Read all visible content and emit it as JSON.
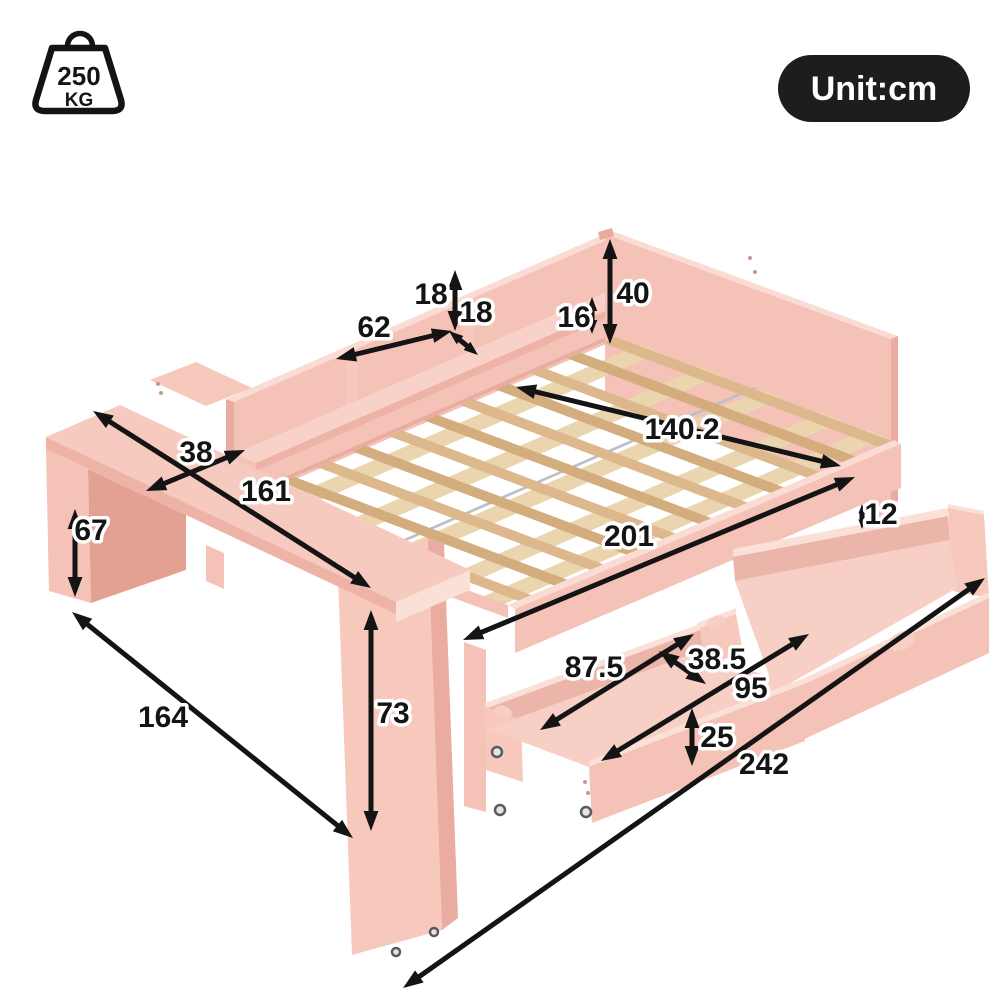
{
  "unit_badge": {
    "label": "Unit:cm"
  },
  "weight_capacity": {
    "value": "250",
    "unit": "KG"
  },
  "unit": "cm",
  "dimensions": [
    {
      "id": "shelf-height",
      "value": "18",
      "label": [
        431,
        293
      ],
      "arrow": [
        455,
        270,
        455,
        331
      ]
    },
    {
      "id": "shelf-depth",
      "value": "18",
      "label": [
        476,
        311
      ],
      "arrow": [
        449,
        331,
        478,
        355
      ]
    },
    {
      "id": "shelf-width",
      "value": "62",
      "label": [
        374,
        326
      ],
      "arrow": [
        336,
        359,
        452,
        331
      ]
    },
    {
      "id": "side-rail-height",
      "value": "16",
      "label": [
        574,
        316
      ],
      "arrow": [
        592,
        297,
        592,
        334
      ]
    },
    {
      "id": "headboard-height",
      "value": "40",
      "label": [
        633,
        292
      ],
      "arrow": [
        610,
        239,
        610,
        344
      ]
    },
    {
      "id": "bed-width",
      "value": "140.2",
      "label": [
        682,
        428
      ],
      "arrow": [
        516,
        387,
        841,
        466
      ]
    },
    {
      "id": "bed-length",
      "value": "201",
      "label": [
        629,
        535
      ],
      "arrow": [
        463,
        640,
        855,
        477
      ]
    },
    {
      "id": "desk-depth",
      "value": "38",
      "label": [
        196,
        451
      ],
      "arrow": [
        146,
        491,
        245,
        450
      ]
    },
    {
      "id": "desk-length",
      "value": "161",
      "label": [
        266,
        490
      ],
      "arrow": [
        93,
        411,
        371,
        588
      ]
    },
    {
      "id": "desk-height",
      "value": "67",
      "label": [
        91,
        529
      ],
      "arrow": [
        75,
        509,
        75,
        597
      ]
    },
    {
      "id": "floor-depth",
      "value": "164",
      "label": [
        163,
        716
      ],
      "arrow": [
        72,
        612,
        353,
        838
      ]
    },
    {
      "id": "foot-panel-height",
      "value": "73",
      "label": [
        393,
        712
      ],
      "arrow": [
        371,
        610,
        371,
        831
      ]
    },
    {
      "id": "drawer-gap",
      "value": "12",
      "label": [
        881,
        513
      ],
      "arrow": [
        862,
        504,
        862,
        529
      ]
    },
    {
      "id": "drawer-left-length",
      "value": "87.5",
      "label": [
        594,
        666
      ],
      "arrow": [
        540,
        730,
        694,
        634
      ]
    },
    {
      "id": "drawer-width",
      "value": "38.5",
      "label": [
        717,
        658
      ],
      "arrow": [
        659,
        651,
        706,
        684
      ]
    },
    {
      "id": "drawer-right-length",
      "value": "95",
      "label": [
        751,
        687
      ],
      "arrow": [
        601,
        761,
        809,
        634
      ]
    },
    {
      "id": "drawer-depth",
      "value": "25",
      "label": [
        717,
        736
      ],
      "arrow": [
        692,
        708,
        692,
        766
      ]
    },
    {
      "id": "total-length",
      "value": "242",
      "label": [
        764,
        763
      ],
      "arrow": [
        985,
        578,
        403,
        988
      ]
    }
  ],
  "colors": {
    "bg": "#ffffff",
    "ink": "#141414",
    "badge_bg": "#1d1d1f",
    "badge_text": "#ffffff",
    "pink_top": "#fadcd4",
    "pink_face": "#f4c2b6",
    "pink_face_light": "#f7c9bd",
    "pink_dark": "#eaaba0",
    "pink_inner": "#ecb5a9",
    "pink_floor": "#f7cfc5",
    "pink_shadow": "#e2a193",
    "pink_edge": "#fbe0d8",
    "wood": "#dcb88c",
    "wood_dark": "#d3ad7e",
    "wood_light": "#ead5ae",
    "metal": "#b9bfc8"
  }
}
